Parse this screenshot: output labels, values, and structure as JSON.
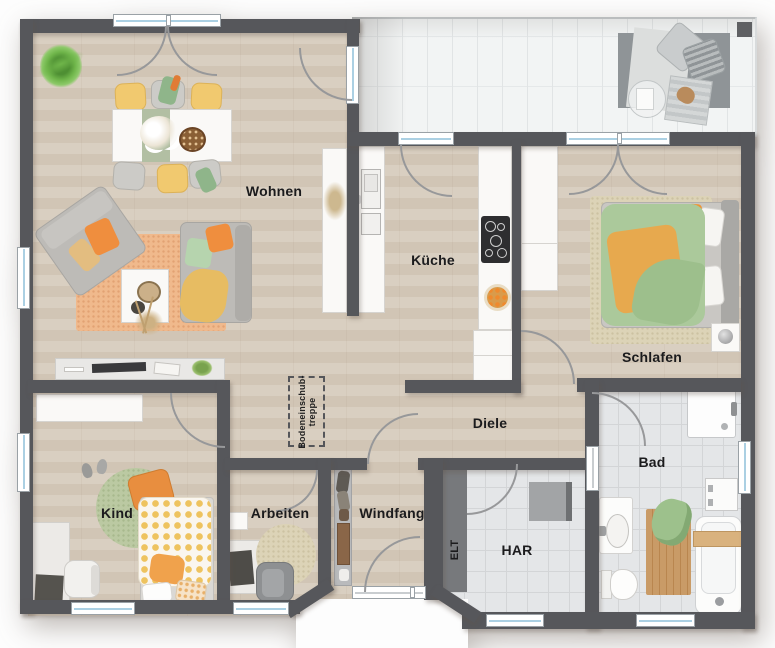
{
  "plan": {
    "type": "apartment-floor-plan",
    "rooms": {
      "wohnen": "Wohnen",
      "kueche": "Küche",
      "schlafen": "Schlafen",
      "diele": "Diele",
      "bad": "Bad",
      "kind": "Kind",
      "arbeiten": "Arbeiten",
      "windfang": "Windfang",
      "har": "HAR",
      "elt": "ELT"
    },
    "annotations": {
      "attic_hatch_line1": "Bodeneinschub-",
      "attic_hatch_line2": "treppe"
    },
    "colors": {
      "wall": "#56575b",
      "wood_floor": "#d7ccbe",
      "tile_floor": "#e4e6e8",
      "terrace_floor": "#f2f4f4",
      "window_glass": "#abd0e3",
      "accent_orange": "#ef8e3e",
      "accent_yellow": "#f1c96f",
      "accent_green": "#abc99b",
      "rug_orange": "#f0b98c"
    }
  }
}
